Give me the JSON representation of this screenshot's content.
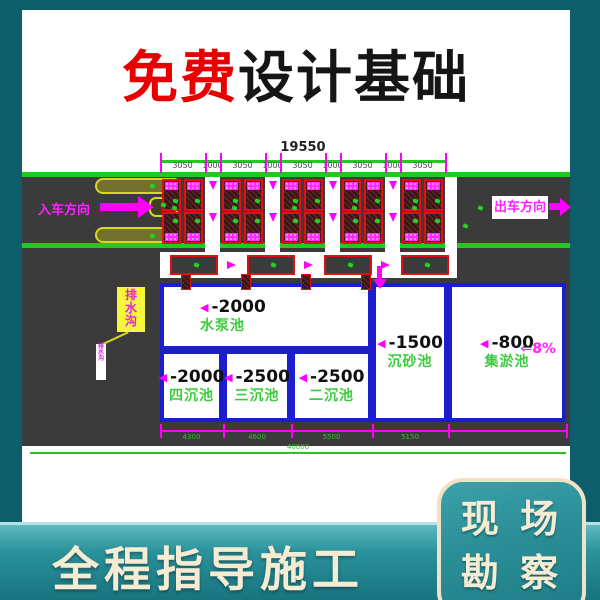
{
  "title": {
    "highlight": "免费",
    "rest": "设计基础"
  },
  "drawing": {
    "total_dim": "19550",
    "segments": [
      "3050",
      "1000",
      "3050",
      "1000",
      "3050",
      "1000",
      "3050",
      "1000",
      "3050"
    ],
    "enter_label": "入车方向",
    "exit_label": "出车方向",
    "drain_label": "排水沟",
    "slope_label": "⇐8%",
    "pools": [
      {
        "depth": "-2000",
        "name": "水泵池"
      },
      {
        "depth": "-2000",
        "name": "四沉池"
      },
      {
        "depth": "-2500",
        "name": "三沉池"
      },
      {
        "depth": "-2500",
        "name": "二沉池"
      },
      {
        "depth": "-1500",
        "name": "沉砂池"
      },
      {
        "depth": "-800",
        "name": "集淤池"
      }
    ],
    "bottom_dims": [
      "4300",
      "4600",
      "5500",
      "5150"
    ],
    "bottom_total": "40000",
    "icons": {
      "depth_marker": "◀"
    }
  },
  "colors": {
    "accent_teal": "#157a85",
    "cad_green": "#1ecb1e",
    "magenta": "#ff00ff",
    "wall_blue": "#1d1dd0",
    "stall_red": "#e01010",
    "title_red": "#e80000"
  },
  "footer": {
    "left_text": "全程指导施工",
    "badge_line1": "现 场",
    "badge_line2": "勘 察"
  }
}
